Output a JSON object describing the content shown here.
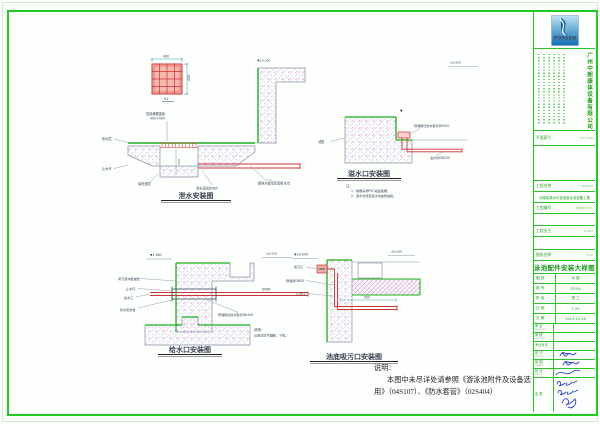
{
  "colors": {
    "frame_green": "#1ecb1e",
    "waterproof_green": "#1db01d",
    "pipe_red": "#cf3333",
    "hatch_pink": "#e27fd2",
    "dim_teal": "#3b9e9e",
    "signature_blue": "#2b3fd0",
    "logo_blue": "#0f6fb4",
    "tb_text_green": "#1ea21e"
  },
  "titleblock": {
    "logo_text": "POSSEN",
    "company_name": "广州中朗康体设备有限公司",
    "key_plan_label": "平面索引",
    "key_plan_en": "KEY PLAN",
    "project_label": "工程名称",
    "project_en": "PROJECT",
    "project_name": "河南省某水疗会馆游泳池设备工程",
    "project_no_label": "工程编号",
    "project_no_en": "PROJECT NO.",
    "client_label": "工程业主",
    "client_en": "CLIENT",
    "title_label": "图纸名称",
    "title_en": "TITLE",
    "drawing_title": "泳池配件安装大样图",
    "fields": [
      {
        "label": "图 别",
        "value": "水 施"
      },
      {
        "label": "图 号",
        "value": "ZP-04"
      },
      {
        "label": "阶 段",
        "value": "施 工"
      },
      {
        "label": "比 例",
        "value": "1:25"
      },
      {
        "label": "日 期",
        "value": "2013-10-28"
      }
    ],
    "sign_rows": [
      {
        "label": "审 定",
        "en": "APPROVED"
      },
      {
        "label": "审 核",
        "en": "CHECKED"
      },
      {
        "label": "专业负责",
        "en": ""
      },
      {
        "label": "设 计",
        "en": "DESIGN"
      },
      {
        "label": "制 图",
        "en": "DRAWN"
      },
      {
        "label": "校 对",
        "en": "PROOF"
      },
      {
        "label": "会 签",
        "en": ""
      }
    ]
  },
  "drawings": {
    "d1": {
      "title": "泄水安装图",
      "dim_top": "400",
      "dim_right": "400",
      "plan_label": "A1",
      "grate_note1": "成品格栅盖板",
      "grate_note2": "400×400",
      "pit_dim": "450",
      "elev": "▼±0.000",
      "waterproof_label": "防水层",
      "stop_ring": "止水环",
      "cushion": "素砼垫层",
      "pipe_note": "接排水管至泵房集水坑",
      "valve_note": "泄水底阀DN65",
      "note_title": "注：",
      "note1": "1、格栅采用PVC成品格栅；",
      "note2": "2、泄水管接至集水坑由泵抽吸。"
    },
    "d2": {
      "title": "溢水口安装图",
      "elev": "▼",
      "elev2": "±0.000",
      "wall_label": "池壁",
      "sleeve_note": "预埋刚性防水套管DN100",
      "pipe_label": "溢水管DN100"
    },
    "d3": {
      "title": "给水口安装图",
      "elev_left": "▼2.380",
      "elev_right": "±0.000",
      "foam_label": "闭孔泡沫板嵌缝",
      "stop_ring": "止水环",
      "inlet_label": "给水口",
      "sealant_label": "防水密封膏",
      "pipe_dn": "DN65",
      "sleeve_note": "预埋刚性防水套管DN100",
      "note1": "说明：",
      "note2": "位置详见平面图，下同。"
    },
    "d4": {
      "title": "池底吸污口安装图",
      "elev_left": "▼±0.000",
      "elev_right": "±0.000",
      "port_label": "吸污口",
      "pipe_label": "预埋管DN50",
      "stop_ring": "止水环",
      "dim": "500"
    }
  },
  "notes": {
    "title": "说明：",
    "line1": "本图中未尽详处请参照《游泳池附件及设备选",
    "line2": "用》（04S107）、《防水套管》（02S404）"
  }
}
